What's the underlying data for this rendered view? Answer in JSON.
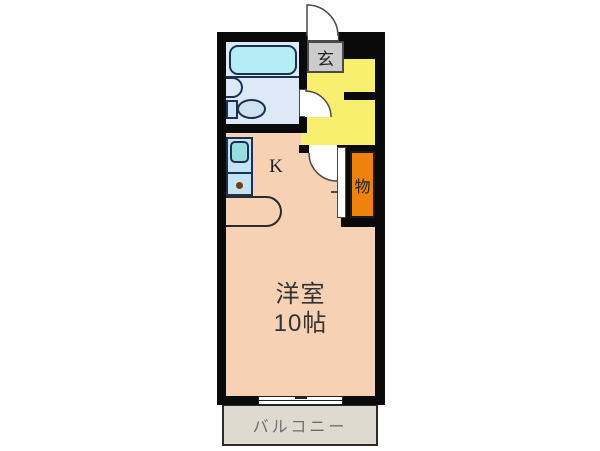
{
  "floorplan": {
    "type": "apartment-floor-plan",
    "rooms": {
      "entrance": {
        "label": "玄"
      },
      "kitchen": {
        "label": "K"
      },
      "closet": {
        "label": "物"
      },
      "main_room": {
        "name": "洋室",
        "size": "10帖"
      },
      "balcony": {
        "label": "バルコニー"
      }
    },
    "fixtures": [
      "bathtub",
      "washbasin",
      "toilet",
      "kitchen-sink",
      "stove-burner"
    ],
    "colors": {
      "wall": "#0a0a0a",
      "main_room_fill": "#f6d1b4",
      "hall_fill": "#f7ef6d",
      "closet_fill": "#ef820d",
      "bathroom_fill": "#dde9f7",
      "bathtub_fill": "#b4edf3",
      "kitchen_unit_fill": "#c6e3f5",
      "kitchen_sink_fill": "#98dcde",
      "genkan_fill": "#cccccc",
      "balcony_fill": "#dfdacf"
    }
  }
}
